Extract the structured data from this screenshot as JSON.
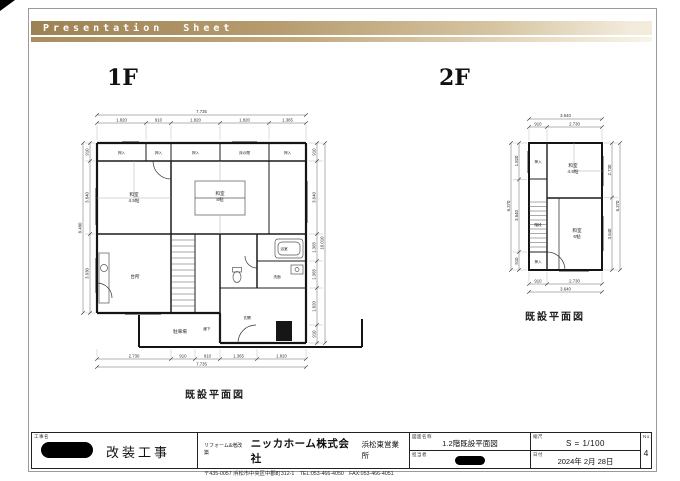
{
  "header": {
    "title": "Presentation  Sheet"
  },
  "floor1": {
    "label": "1F",
    "caption": "既設平面図",
    "dims": {
      "top_total": "7.735",
      "top": [
        "1.820",
        "910",
        "1.820",
        "1.820",
        "1.365"
      ],
      "bottom_total": "7.735",
      "bottom": [
        "2.730",
        "910",
        "910",
        "1.365",
        "1.820"
      ],
      "left_total": "8.480",
      "left": [
        "910",
        "3.640",
        "3.930"
      ],
      "right_total": "10.010",
      "right": [
        "910",
        "3.640",
        "1.365",
        "1.365",
        "1.820",
        "910"
      ]
    },
    "rooms": {
      "oshiire1": "押入",
      "oshiire2": "押入",
      "oshiire3": "押入",
      "tokonoma": "床の間",
      "oshiire4": "押入",
      "washitsu45_l1": "和室",
      "washitsu45_l2": "4.5帖",
      "washitsu8_l1": "和室",
      "washitsu8_l2": "8帖",
      "kitchen": "台所",
      "bath": "浴室",
      "wash": "洗面",
      "hall": "廊下",
      "entry": "玄関",
      "garage": "駐車場"
    }
  },
  "floor2": {
    "label": "2F",
    "caption": "既設平面図",
    "dims": {
      "top_total": "3.640",
      "top": [
        "910",
        "2.730"
      ],
      "bottom_total": "3.640",
      "bottom": [
        "910",
        "2.730"
      ],
      "left_total": "6.370",
      "left": [
        "1.820",
        "3.640",
        "910"
      ],
      "right_total": "6.370",
      "right": [
        "2.730",
        "3.640"
      ]
    },
    "rooms": {
      "oshiire_top": "押入",
      "washitsu45_l1": "和室",
      "washitsu45_l2": "4.5帖",
      "stairs": "階段",
      "washitsu6_l1": "和室",
      "washitsu6_l2": "6帖",
      "oshiire_bottom": "押入"
    }
  },
  "titleblock": {
    "project_label": "工事名",
    "project": "改装工事",
    "company_tagline": "リフォーム&増改築",
    "company": "ニッカホーム株式会社",
    "office": "浜松東営業所",
    "address": "〒435-0057  浜松市中央区中郡町312-1　TEL:053-466-4050　FAX:053-466-4051",
    "drawing_label": "図面名称",
    "drawing_name": "1.2階既設平面図",
    "staff_label": "担当者",
    "scale_label": "縮尺",
    "scale": "S = 1/100",
    "date_label": "日付",
    "date": "2024年 2月 28日",
    "no_label": "No.",
    "page_no": "4"
  }
}
